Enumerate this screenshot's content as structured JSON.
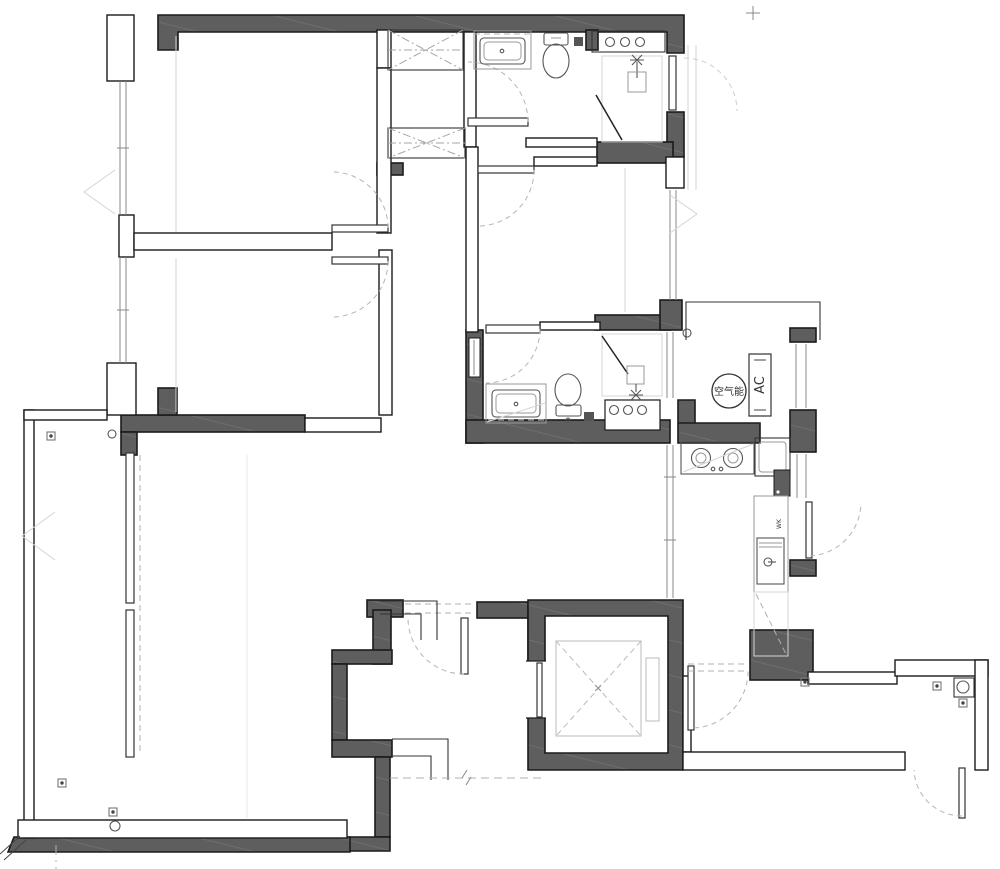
{
  "drawing": {
    "kind": "apartment floor plan (CAD line drawing)",
    "labels": {
      "heat_pump": "空气能",
      "ac": "AC",
      "water_heater": "WK"
    },
    "colors": {
      "background": "#ffffff",
      "wall_fill": "#5e5e5e",
      "wall_hatch": "#6e6e6e",
      "wall_stroke": "#1b1b1b",
      "fixture_line": "#555555",
      "light_line": "#9a9a9a",
      "door_arc": "#b5b5b5"
    },
    "icons": {
      "wardrobe": "rectangle-with-crossed-diagonals",
      "elevator_car": "square-with-dashed-X",
      "toilet": "tank-and-oval-bowl",
      "vanity_sink": "counter-with-rounded-basin",
      "shower": "glass-diagonal-with-shower-head",
      "gas_stove": "two-burner-cooktop",
      "kitchen_sink": "inset-basin",
      "floor_drain": "small-square-with-dot",
      "heat_pump_unit": "circle",
      "ac_platform_unit": "tall-rectangle"
    }
  }
}
